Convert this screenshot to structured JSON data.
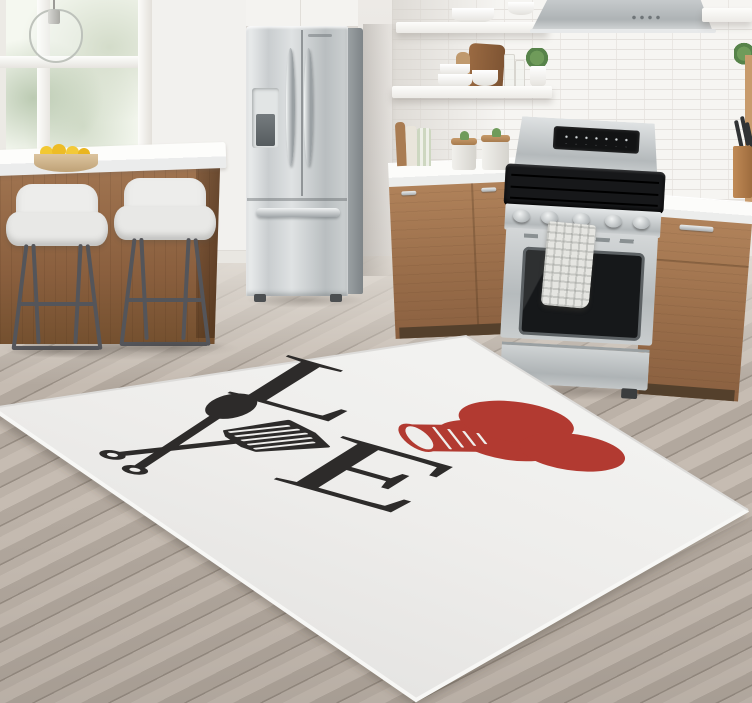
{
  "scene": {
    "setting": "modern kitchen with a LOVE cooking-themed area rug",
    "objects": [
      "window",
      "pendant-light",
      "kitchen-island",
      "bar-stools",
      "fruit-bowl",
      "refrigerator",
      "floating-shelves",
      "range-hood",
      "subway-tile-backsplash",
      "gas-range",
      "kitchen-towel",
      "wood-cabinets",
      "knife-block",
      "area-rug",
      "wood-floor"
    ]
  },
  "rug": {
    "letters": {
      "top_left": "L",
      "bottom_right": "E"
    },
    "motifs": [
      "crossed-spoon-and-spatula",
      "chef-hat-heart"
    ],
    "colors": {
      "base": "#efeeec",
      "ink": "#2d2b2a",
      "accent_red": "#b23a31"
    }
  },
  "palette": {
    "wall": "#e9e6e2",
    "tile": "#f6f5f2",
    "floor_wood": "#b6aca2",
    "cabinet_wood": "#9a6e4a",
    "stainless": "#c6cacc",
    "counter": "#fbfbf9",
    "lemon_yellow": "#f0c32f",
    "plant_green": "#6f9b5a"
  }
}
